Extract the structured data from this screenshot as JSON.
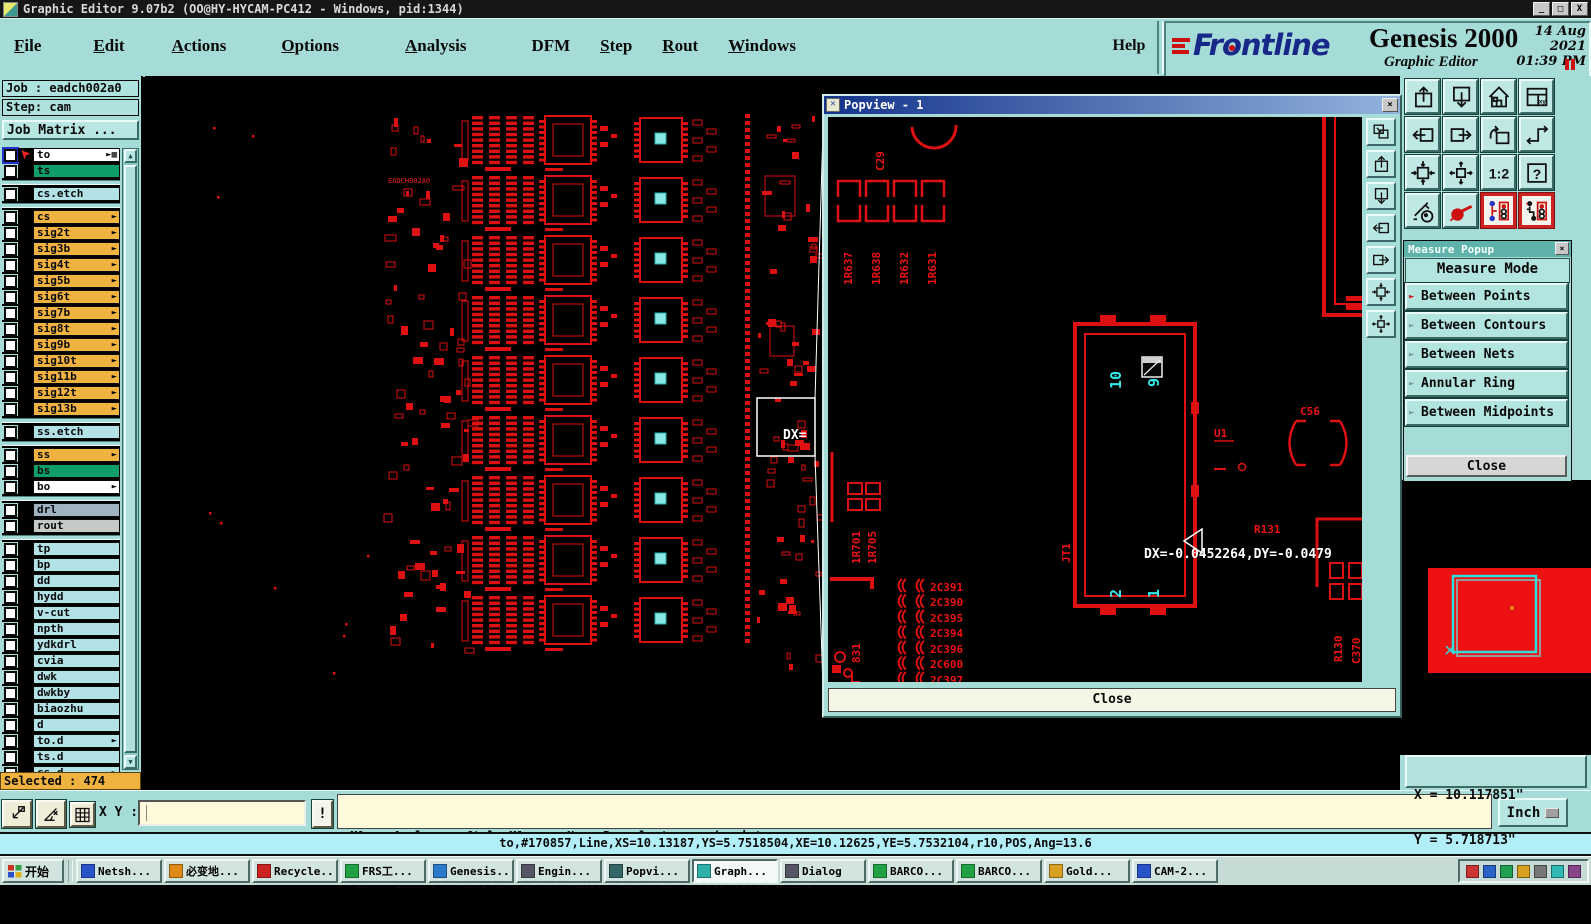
{
  "titlebar": {
    "title": "Graphic Editor 9.07b2 (OO@HY-HYCAM-PC412 - Windows, pid:1344)",
    "minimize": "_",
    "maximize": "□",
    "close": "X"
  },
  "menubar": {
    "items": [
      {
        "label": "File",
        "underline": 0
      },
      {
        "label": "Edit",
        "underline": 0
      },
      {
        "label": "Actions",
        "underline": 0
      },
      {
        "label": "Options",
        "underline": 0
      },
      {
        "label": "Analysis",
        "underline": 0
      },
      {
        "label": "DFM",
        "underline": -1
      },
      {
        "label": "Step",
        "underline": 0
      },
      {
        "label": "Rout",
        "underline": 0
      },
      {
        "label": "Windows",
        "underline": 0
      }
    ],
    "help": "Help"
  },
  "brand": {
    "logo_text": "Frontline",
    "product": "Genesis 2000",
    "edition": "Graphic Editor",
    "date": "14 Aug 2021",
    "time": "01:39 PM"
  },
  "sidebar": {
    "job": "Job : eadch002a0",
    "step": "Step: cam",
    "job_matrix": "Job Matrix ...",
    "selected": "Selected : 474",
    "scroll_up": "▲",
    "scroll_down": "▼",
    "hand_glyph": "►",
    "grid_glyph": "▦",
    "layers": [
      {
        "label": "to",
        "bg": "white",
        "hand": true,
        "grid": true,
        "active": true
      },
      {
        "label": "ts",
        "bg": "green"
      },
      {
        "gap": true
      },
      {
        "label": "cs.etch",
        "bg": "blue"
      },
      {
        "gap": true
      },
      {
        "label": "cs",
        "bg": "orange",
        "hand": true
      },
      {
        "label": "sig2t",
        "bg": "orange",
        "hand": true
      },
      {
        "label": "sig3b",
        "bg": "orange",
        "hand": true
      },
      {
        "label": "sig4t",
        "bg": "orange",
        "hand": true
      },
      {
        "label": "sig5b",
        "bg": "orange",
        "hand": true
      },
      {
        "label": "sig6t",
        "bg": "orange",
        "hand": true
      },
      {
        "label": "sig7b",
        "bg": "orange",
        "hand": true
      },
      {
        "label": "sig8t",
        "bg": "orange",
        "hand": true
      },
      {
        "label": "sig9b",
        "bg": "orange",
        "hand": true
      },
      {
        "label": "sig10t",
        "bg": "orange",
        "hand": true
      },
      {
        "label": "sig11b",
        "bg": "orange",
        "hand": true
      },
      {
        "label": "sig12t",
        "bg": "orange",
        "hand": true
      },
      {
        "label": "sig13b",
        "bg": "orange",
        "hand": true
      },
      {
        "gap": true
      },
      {
        "label": "ss.etch",
        "bg": "blue"
      },
      {
        "gap": true
      },
      {
        "label": "ss",
        "bg": "orange",
        "hand": true
      },
      {
        "label": "bs",
        "bg": "green"
      },
      {
        "label": "bo",
        "bg": "white",
        "hand": true
      },
      {
        "gap": true
      },
      {
        "label": "drl",
        "bg": "drl"
      },
      {
        "label": "rout",
        "bg": "rout"
      },
      {
        "gap": true
      },
      {
        "label": "tp",
        "bg": "blue"
      },
      {
        "label": "bp",
        "bg": "blue"
      },
      {
        "label": "dd",
        "bg": "blue"
      },
      {
        "label": "hydd",
        "bg": "blue"
      },
      {
        "label": "v-cut",
        "bg": "blue"
      },
      {
        "label": "npth",
        "bg": "blue"
      },
      {
        "label": "ydkdrl",
        "bg": "blue"
      },
      {
        "label": "cvia",
        "bg": "blue"
      },
      {
        "label": "dwk",
        "bg": "blue"
      },
      {
        "label": "dwkby",
        "bg": "blue"
      },
      {
        "label": "biaozhu",
        "bg": "blue"
      },
      {
        "label": "d",
        "bg": "blue"
      },
      {
        "label": "to.d",
        "bg": "blue",
        "hand": true
      },
      {
        "label": "ts.d",
        "bg": "blue"
      },
      {
        "label": "cs.d",
        "bg": "blue",
        "hand": true
      }
    ]
  },
  "canvas": {
    "board_text": "EADCH002A0",
    "zoom_rect_label": "DX="
  },
  "popview": {
    "title": "Popview - 1",
    "close_x": "×",
    "close_button": "Close",
    "toolbar": [
      "window-copy",
      "paste-up",
      "paste-down",
      "pan-left",
      "pan-right",
      "zoom-margins",
      "zoom-selection"
    ],
    "refdes": [
      "C29",
      "1R637",
      "1R638",
      "1R632",
      "1R631",
      "JT1",
      "U1",
      "C56",
      "R131",
      "R130",
      "C370",
      "1R701",
      "1R705",
      "831",
      "2C391",
      "2C390",
      "2C395",
      "2C394",
      "2C396",
      "2C600",
      "2C397"
    ],
    "pins": [
      "10",
      "9",
      "2",
      "1"
    ],
    "measure_text": "DX=-0.0452264,DY=-0.0479"
  },
  "measure": {
    "title": "Measure Popup",
    "close_x": "×",
    "header": "Measure Mode",
    "arrow_glyph": "►",
    "options": [
      {
        "label": "Between Points",
        "selected": true
      },
      {
        "label": "Between Contours",
        "selected": false
      },
      {
        "label": "Between Nets",
        "selected": false
      },
      {
        "label": "Annular Ring",
        "selected": false
      },
      {
        "label": "Between Midpoints",
        "selected": false
      }
    ],
    "close": "Close"
  },
  "toolbar": {
    "buttons": [
      "paste-up",
      "paste-down",
      "home",
      "window-xy",
      "pan-left",
      "pan-right",
      "undo-view",
      "serpentine",
      "zoom-margins",
      "zoom-selection",
      "ratio-1-2",
      "help",
      "graphic-tools",
      "measure-probe",
      "net-highlight-a",
      "net-highlight-b"
    ]
  },
  "readout": {
    "x": "X = 10.117851\"",
    "y": "Y = 5.718713\""
  },
  "bottombar": {
    "buttons": [
      "track-cursor",
      "angle-measure",
      "grid-snap"
    ],
    "xy_label": "X Y :",
    "input_value": "",
    "alert": "!",
    "msg1": "<M1> - Apply  ; <Ctrl><M1> or <N> - Re-select second point",
    "msg2": "<M2> - Cancel ; <Shift><M1> or <Shift><N> - Re-select first point",
    "units": "Inch"
  },
  "statusline": "to,#170857,Line,XS=10.13187,YS=5.7518504,XE=10.12625,YE=5.7532104,r10,POS,Ang=13.6",
  "taskbar": {
    "start": "开始",
    "buttons": [
      {
        "label": "Netsh...",
        "color": "#2a52c8"
      },
      {
        "label": "必变地...",
        "color": "#e08818"
      },
      {
        "label": "Recycle...",
        "color": "#cc2222"
      },
      {
        "label": "FRS工...",
        "color": "#22a044"
      },
      {
        "label": "Genesis...",
        "color": "#2a7ac8"
      },
      {
        "label": "Engin...",
        "color": "#555566"
      },
      {
        "label": "Popvi...",
        "color": "#336666"
      },
      {
        "label": "Graph...",
        "color": "#30b0a8",
        "active": true
      },
      {
        "label": "Dialog",
        "color": "#555566"
      },
      {
        "label": "BARCO...",
        "color": "#22a044"
      },
      {
        "label": "BARCO...",
        "color": "#22a044"
      },
      {
        "label": "Gold...",
        "color": "#d8a020"
      },
      {
        "label": "CAM-2...",
        "color": "#2a52c8"
      }
    ],
    "tray_icons": [
      "#cc3333",
      "#2a62c8",
      "#22a052",
      "#d8a020",
      "#777777",
      "#30b8b4",
      "#884488"
    ]
  },
  "colors": {
    "ui_teal": "#a6dcd8",
    "pcb_red": "#dd1111",
    "pad_cyan": "#8ae8e4",
    "layer_orange": "#f0b342",
    "layer_green": "#0f9e6a",
    "layer_blue": "#b2e2e6",
    "layer_drl": "#9fb4c0",
    "layer_rout": "#c6cac6",
    "selected_orange": "#f0b342",
    "beige": "#fdf9da",
    "status_cyan": "#b2eef8"
  }
}
